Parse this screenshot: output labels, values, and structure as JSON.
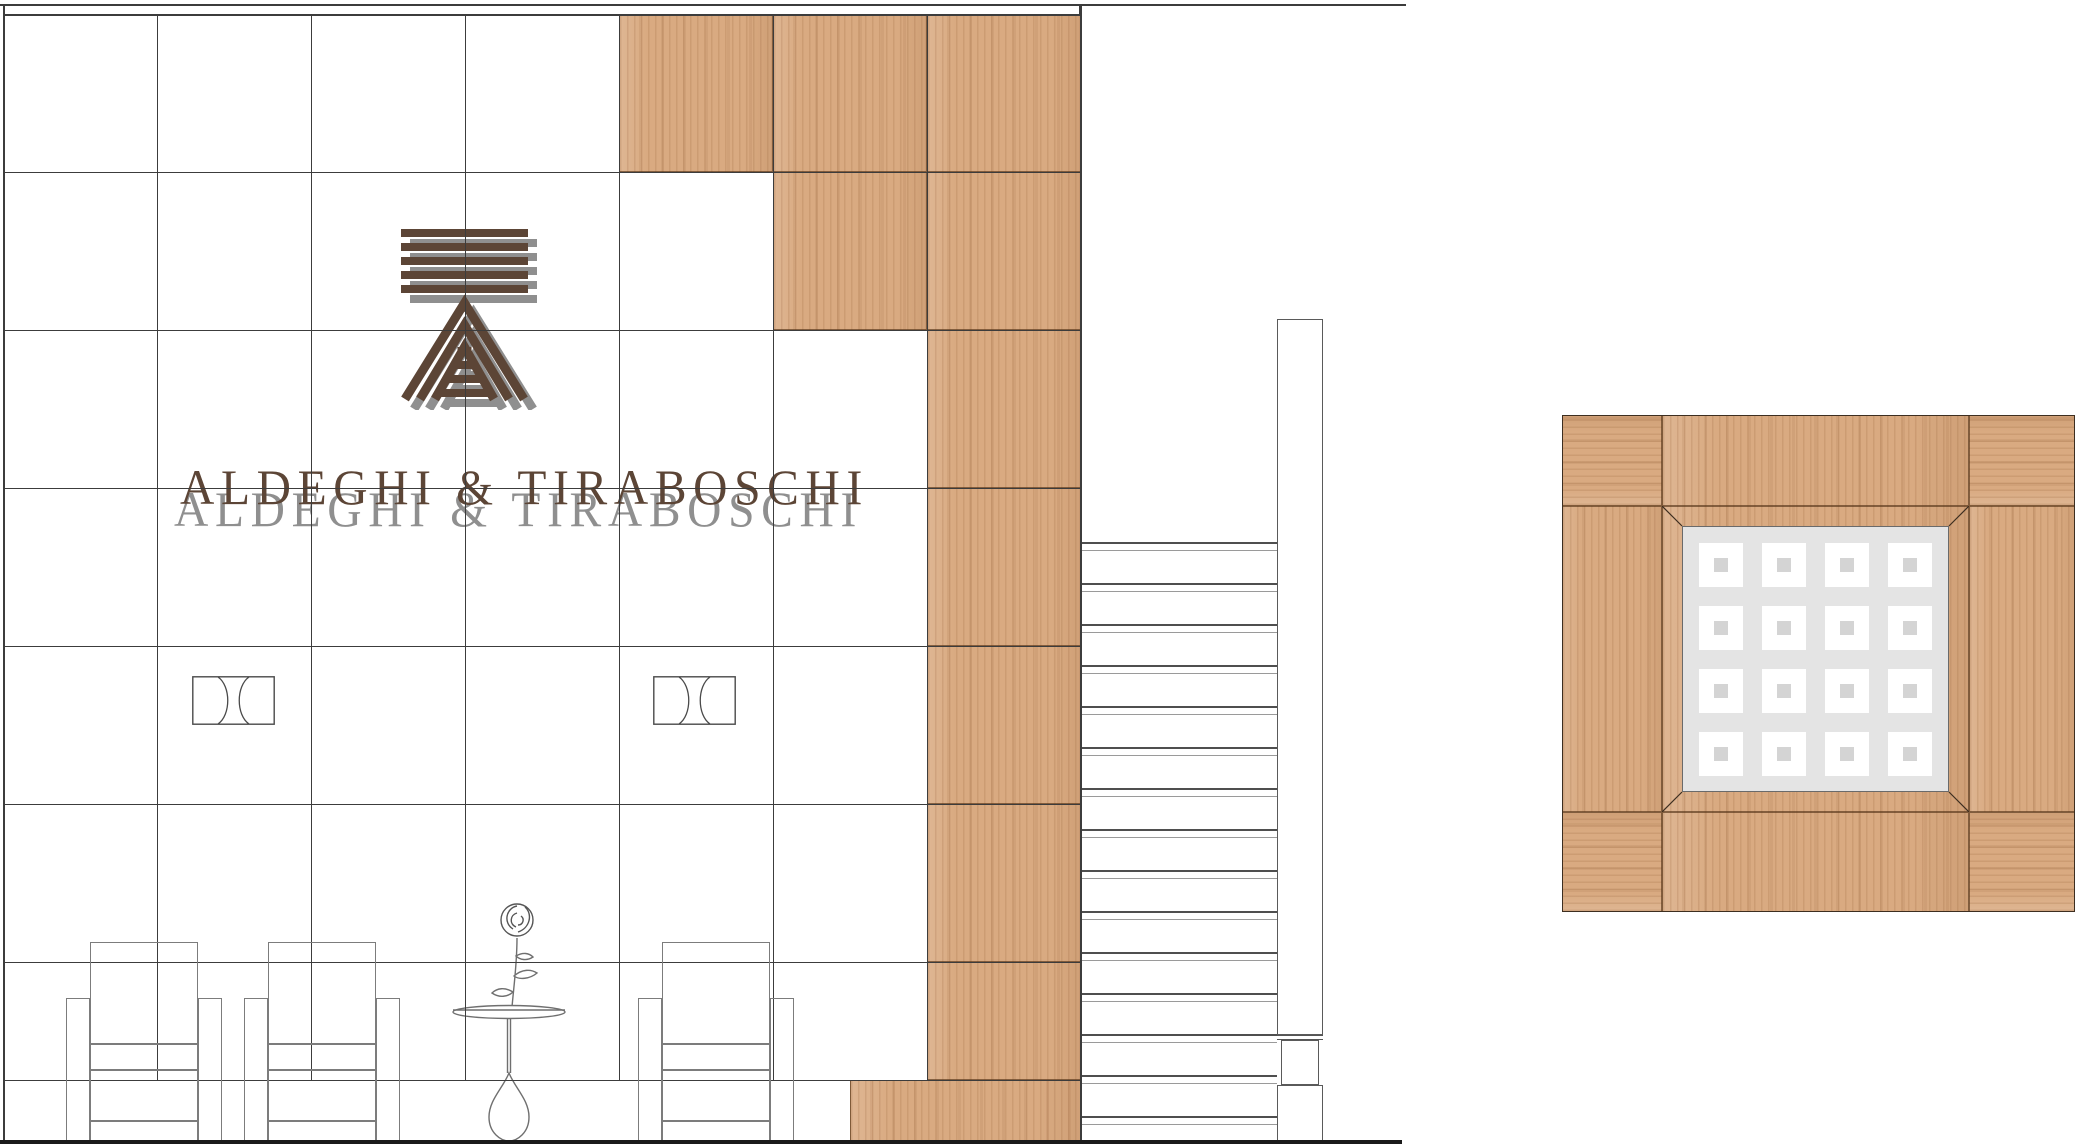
{
  "brand": {
    "wordmark": "ALDEGHI & TIRABOSCHI",
    "logo_icon": "striped-a-monogram",
    "brown": "#5c4536",
    "shadow_gray": "#8f8f8f"
  },
  "colors": {
    "background": "#ffffff",
    "grid_line": "#3c3c3c",
    "furniture_line": "#7c7c7c",
    "rung_dark": "#4f4f4f",
    "rung_light": "#9a9a9a",
    "wood_base": "#d9aa81",
    "wood_seam": "rgba(84,52,25,0.65)",
    "panel_gray": "#e4e4e4",
    "square_white": "#ffffff",
    "square_inner": "#d4d4d4",
    "floor_line": "#1a1a1a"
  },
  "drawing": {
    "canvas": {
      "w": 2083,
      "h": 1146
    },
    "top_line": {
      "y": 4,
      "x0": 0,
      "x1": 1406,
      "tick_x": 1079
    },
    "elevation": {
      "wall": {
        "x0": 3,
        "y0": 14,
        "x1": 1081,
        "floor_y": 1141
      },
      "grid": {
        "cols": [
          157,
          311,
          465,
          619,
          773,
          927
        ],
        "rows": [
          14,
          172,
          330,
          488,
          646,
          804,
          962,
          1080
        ]
      },
      "wood_cells": [
        {
          "x": 619,
          "y": 14,
          "w": 154,
          "h": 158
        },
        {
          "x": 773,
          "y": 14,
          "w": 154,
          "h": 158
        },
        {
          "x": 927,
          "y": 14,
          "w": 154,
          "h": 158
        },
        {
          "x": 773,
          "y": 172,
          "w": 154,
          "h": 158
        },
        {
          "x": 927,
          "y": 172,
          "w": 154,
          "h": 158
        },
        {
          "x": 927,
          "y": 330,
          "w": 154,
          "h": 158
        },
        {
          "x": 927,
          "y": 488,
          "w": 154,
          "h": 158
        },
        {
          "x": 927,
          "y": 646,
          "w": 154,
          "h": 158
        },
        {
          "x": 927,
          "y": 804,
          "w": 154,
          "h": 158
        },
        {
          "x": 927,
          "y": 962,
          "w": 154,
          "h": 118
        },
        {
          "x": 850,
          "y": 1080,
          "w": 231,
          "h": 61
        }
      ],
      "sconces": {
        "y": 676,
        "w": 83,
        "h": 49,
        "xs": [
          192,
          653
        ]
      },
      "chairs": {
        "back_xs": [
          90,
          268,
          662
        ],
        "back_w": 108,
        "arm_w": 24,
        "back_top": 942,
        "arm_top": 998,
        "seat_lines": [
          1043,
          1069,
          1120
        ],
        "bottom": 1141
      },
      "ladder": {
        "rung_x": 1082,
        "rung_w": 195,
        "first_y": 542,
        "step": 41,
        "count": 15,
        "pair_gap": 8,
        "post": {
          "x": 1277,
          "w": 46,
          "top": 319,
          "cap_y": 1035,
          "narrow_x": 1281,
          "narrow_w": 38,
          "narrow_top": 1040,
          "base_top": 1085,
          "bottom": 1141
        }
      },
      "floor": {
        "x0": 0,
        "x1": 1402,
        "y": 1140,
        "h": 4
      }
    },
    "plan_detail": {
      "x": 1562,
      "y": 415,
      "w": 513,
      "h": 497,
      "pieces": [
        {
          "x": 1562,
          "y": 415,
          "w": 100,
          "h": 91,
          "grain": "h"
        },
        {
          "x": 1662,
          "y": 415,
          "w": 307,
          "h": 91,
          "grain": "v"
        },
        {
          "x": 1969,
          "y": 415,
          "w": 106,
          "h": 91,
          "grain": "h"
        },
        {
          "x": 1562,
          "y": 506,
          "w": 100,
          "h": 306,
          "grain": "v"
        },
        {
          "x": 1969,
          "y": 506,
          "w": 106,
          "h": 306,
          "grain": "v"
        },
        {
          "x": 1562,
          "y": 812,
          "w": 100,
          "h": 100,
          "grain": "h"
        },
        {
          "x": 1662,
          "y": 812,
          "w": 307,
          "h": 100,
          "grain": "v"
        },
        {
          "x": 1969,
          "y": 812,
          "w": 106,
          "h": 100,
          "grain": "h"
        },
        {
          "x": 1662,
          "y": 506,
          "w": 307,
          "h": 306,
          "grain": "v"
        }
      ],
      "panel": {
        "x": 1682,
        "y": 526,
        "w": 267,
        "h": 266
      },
      "squares": {
        "n": 4,
        "size": 44,
        "margin": 17,
        "inner": 14
      }
    }
  }
}
